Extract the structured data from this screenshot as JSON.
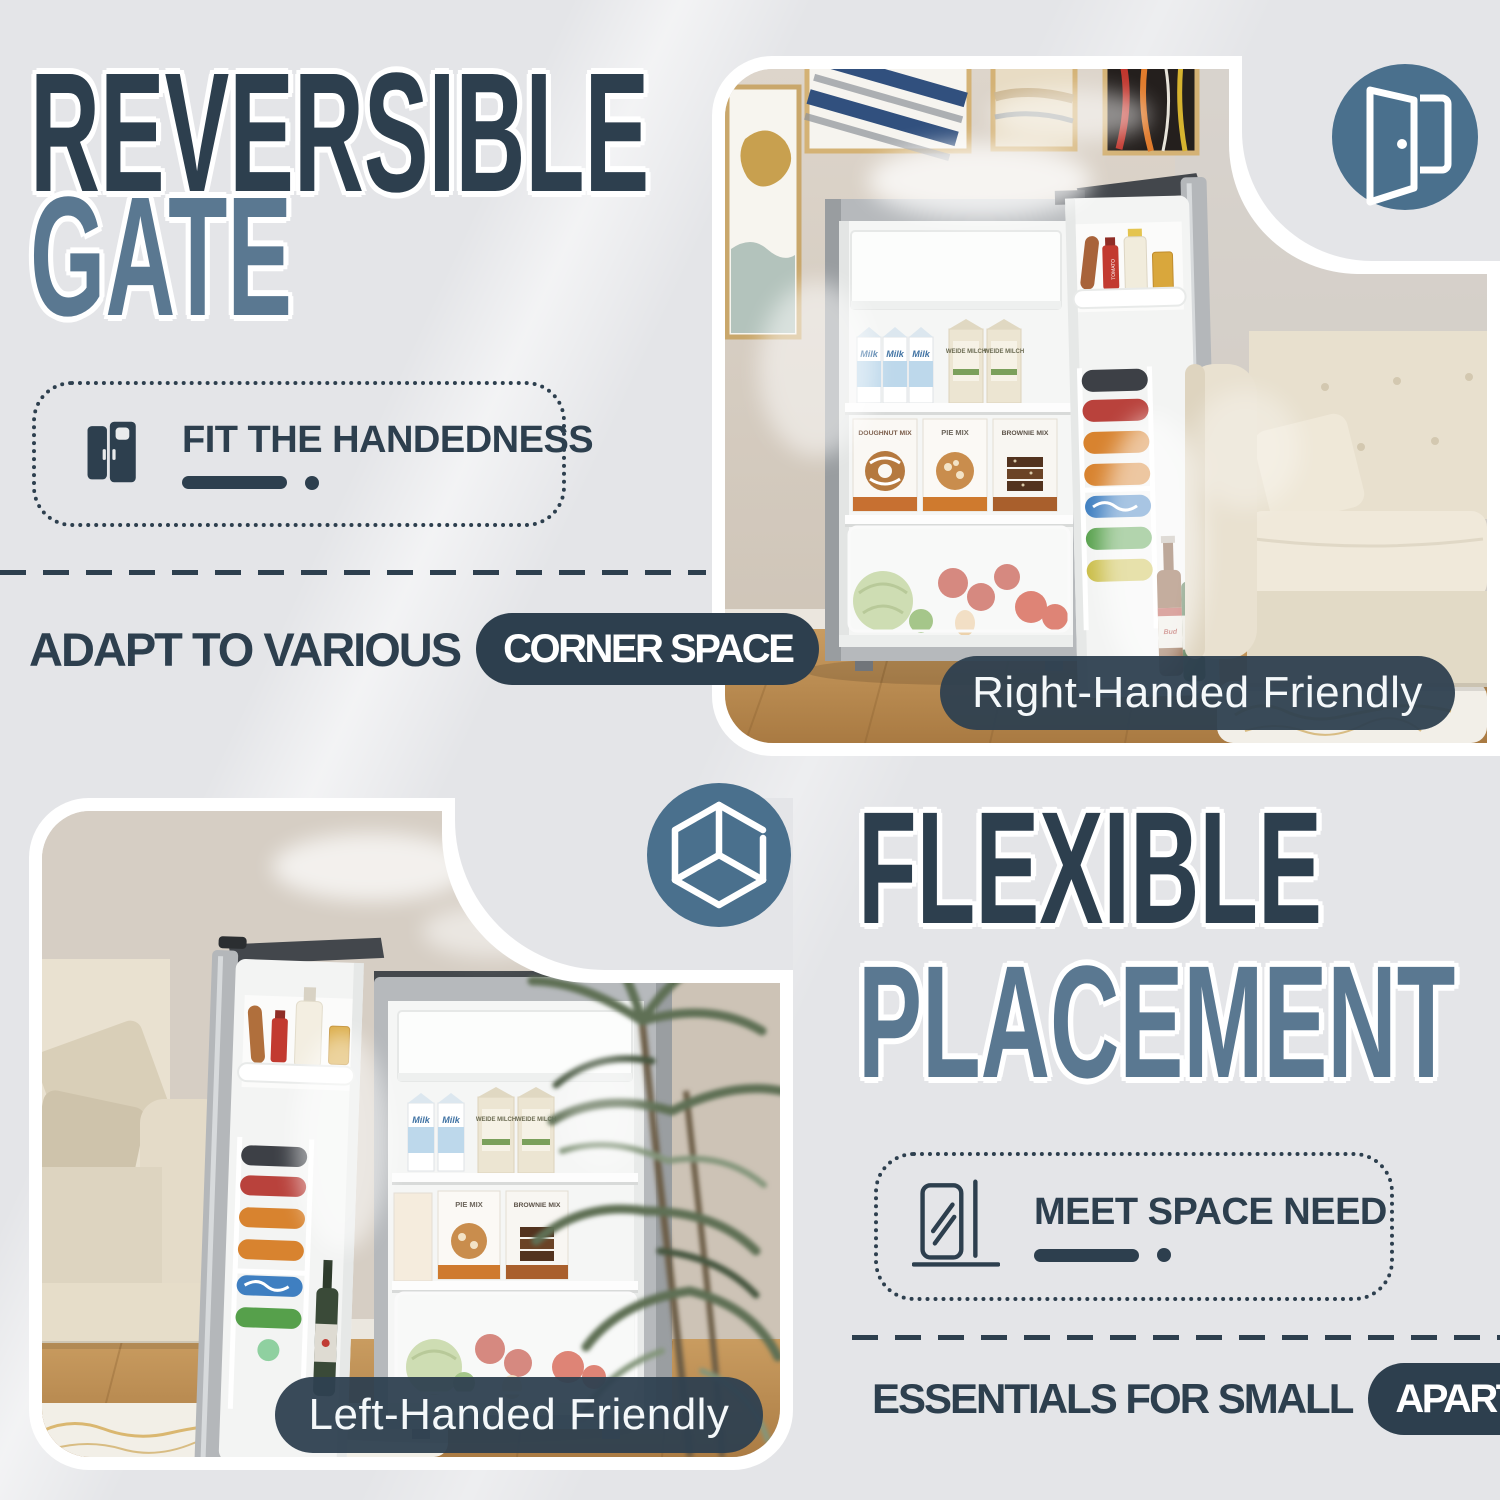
{
  "colors": {
    "background": "#e4e5e8",
    "ink_dark": "#2d3f4e",
    "ink_light": "#5a7891",
    "badge_blue": "#4a708d",
    "caption_bg": "#2e4050",
    "caption_text": "#f4f8fa"
  },
  "reversible_section": {
    "title_line1": "REVERSIBLE",
    "title_line2": "GATE",
    "feature": {
      "icon": "double-fridge-door-icon",
      "label": "FIT THE HANDEDNESS"
    },
    "tagline_prefix": "ADAPT TO VARIOUS",
    "tagline_highlight": "CORNER SPACE",
    "photo_badge_icon": "open-door-icon",
    "photo_caption": "Right-Handed Friendly"
  },
  "flexible_section": {
    "title_line1": "FLEXIBLE",
    "title_line2": "PLACEMENT",
    "feature": {
      "icon": "fridge-beside-wall-icon",
      "label": "MEET SPACE NEED"
    },
    "tagline_prefix": "ESSENTIALS FOR SMALL",
    "tagline_highlight": "APARTMENTS",
    "photo_badge_icon": "cube-icon",
    "photo_caption": "Left-Handed Friendly"
  },
  "fridge_labels": {
    "milk": "Milk",
    "weide_milch": "WEIDE MILCH",
    "doughnut_mix": "DOUGHNUT MIX",
    "pie_mix": "PIE MIX",
    "brownie_mix": "BROWNIE MIX",
    "ketchup": "TOMATO",
    "beer": "Bud"
  }
}
